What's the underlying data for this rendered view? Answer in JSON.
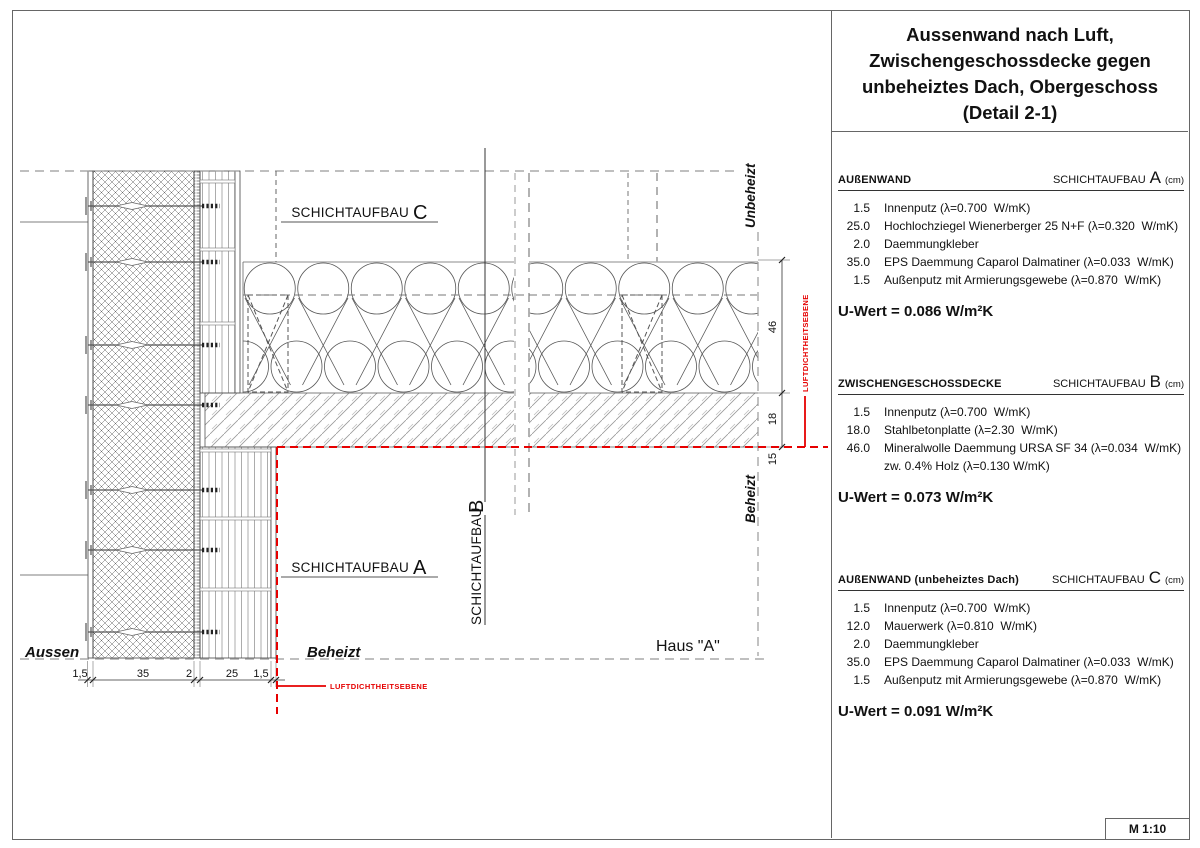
{
  "title": {
    "line1": "Aussenwand nach Luft,",
    "line2": "Zwischengeschossdecke gegen",
    "line3": "unbeheiztes Dach, Obergeschoss",
    "line4": "(Detail 2-1)"
  },
  "panel": {
    "schichtaufbau_word": "SCHICHTAUFBAU",
    "unit": "(cm)",
    "sections": [
      {
        "name": "AUßENWAND",
        "letter": "A",
        "layers": [
          {
            "d": "1.5",
            "t": "Innenputz (λ=0.700  W/mK)"
          },
          {
            "d": "25.0",
            "t": "Hochlochziegel Wienerberger 25 N+F (λ=0.320  W/mK)"
          },
          {
            "d": "2.0",
            "t": "Daemmungkleber"
          },
          {
            "d": "35.0",
            "t": "EPS Daemmung Caparol Dalmatiner (λ=0.033  W/mK)"
          },
          {
            "d": "1.5",
            "t": "Außenputz mit Armierungsgewebe (λ=0.870  W/mK)"
          }
        ],
        "uwert": "U-Wert = 0.086 W/m²K"
      },
      {
        "name": "ZWISCHENGESCHOSSDECKE",
        "letter": "B",
        "layers": [
          {
            "d": "1.5",
            "t": "Innenputz (λ=0.700  W/mK)"
          },
          {
            "d": "18.0",
            "t": "Stahlbetonplatte (λ=2.30  W/mK)"
          },
          {
            "d": "46.0",
            "t": "Mineralwolle Daemmung URSA SF 34 (λ=0.034  W/mK)"
          },
          {
            "d": "",
            "t": "zw. 0.4% Holz (λ=0.130 W/mK)"
          }
        ],
        "uwert": "U-Wert = 0.073 W/m²K"
      },
      {
        "name": "AUßENWAND (unbeheiztes Dach)",
        "letter": "C",
        "layers": [
          {
            "d": "1.5",
            "t": "Innenputz (λ=0.700  W/mK)"
          },
          {
            "d": "12.0",
            "t": "Mauerwerk (λ=0.810  W/mK)"
          },
          {
            "d": "2.0",
            "t": "Daemmungkleber"
          },
          {
            "d": "35.0",
            "t": "EPS Daemmung Caparol Dalmatiner (λ=0.033  W/mK)"
          },
          {
            "d": "1.5",
            "t": "Außenputz mit Armierungsgewebe (λ=0.870  W/mK)"
          }
        ],
        "uwert": "U-Wert = 0.091 W/m²K"
      }
    ]
  },
  "drawing": {
    "label_prefix": "SCHICHTAUFBAU",
    "label_a": "A",
    "label_b": "B",
    "label_c": "C",
    "zone_aussen": "Aussen",
    "zone_beheizt_bottom": "Beheizt",
    "zone_unbeheizt": "Unbeheizt",
    "zone_beheizt_right": "Beheizt",
    "haus_label": "Haus \"A\"",
    "airtight_label_bottom": "LUFTDICHTHEITSEBENE",
    "airtight_label_right": "LUFTDICHTHEITSEBENE",
    "dims_bottom": [
      "1,5",
      "35",
      "2",
      "25",
      "1,5"
    ],
    "dims_right": [
      "46",
      "18",
      "15"
    ],
    "airtight_color": "#e60000"
  },
  "scale_label": "M 1:10"
}
